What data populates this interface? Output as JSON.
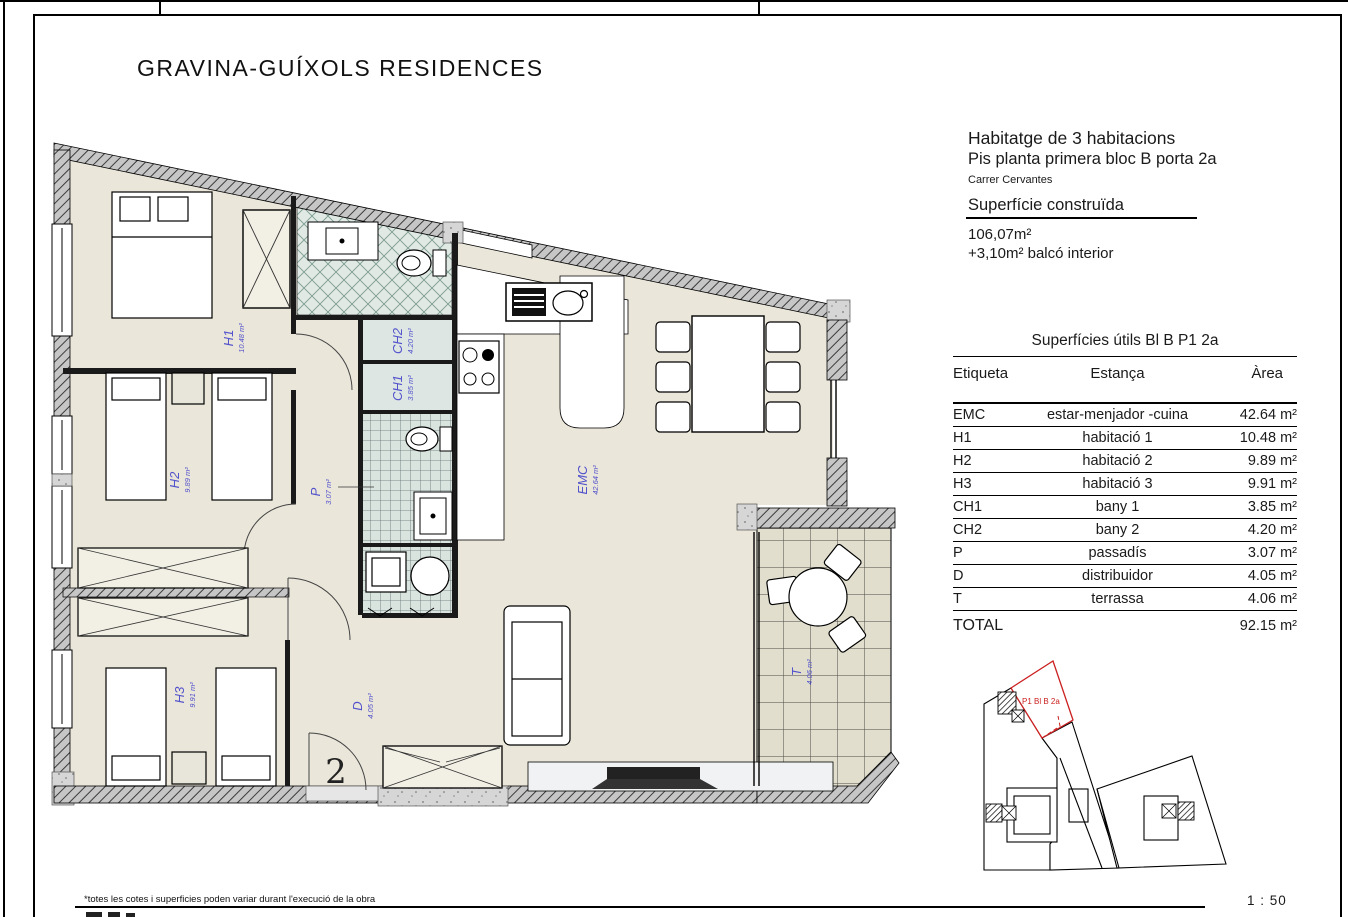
{
  "page": {
    "project_title": "GRAVINA-GUÍXOLS RESIDENCES",
    "scale": "1 : 50",
    "footnote": "*totes les cotes i superficies poden variar durant l'execució de la obra"
  },
  "info": {
    "heading": "Habitatge de 3 habitacions",
    "subheading": "Pis planta primera bloc B porta 2a",
    "address": "Carrer Cervantes",
    "built_section_title": "Superfície construïda",
    "built_area": "106,07m²",
    "balcony_area": "+3,10m² balcó interior"
  },
  "areas_table": {
    "title": "Superfícies útils Bl B P1 2a",
    "columns": [
      "Etiqueta",
      "Estança",
      "Àrea"
    ],
    "rows": [
      {
        "tag": "EMC",
        "room": "estar-menjador -cuina",
        "area": "42.64 m²"
      },
      {
        "tag": "H1",
        "room": "habitació 1",
        "area": "10.48 m²"
      },
      {
        "tag": "H2",
        "room": "habitació 2",
        "area": "9.89 m²"
      },
      {
        "tag": "H3",
        "room": "habitació 3",
        "area": "9.91 m²"
      },
      {
        "tag": "CH1",
        "room": "bany 1",
        "area": "3.85 m²"
      },
      {
        "tag": "CH2",
        "room": "bany 2",
        "area": "4.20 m²"
      },
      {
        "tag": "P",
        "room": "passadís",
        "area": "3.07 m²"
      },
      {
        "tag": "D",
        "room": "distribuidor",
        "area": "4.05 m²"
      },
      {
        "tag": "T",
        "room": "terrassa",
        "area": "4.06 m²"
      }
    ],
    "total_label": "TOTAL",
    "total_area": "92.15 m²"
  },
  "plan": {
    "labels": {
      "h1": {
        "name": "H1",
        "area": "10.48 m²"
      },
      "h2": {
        "name": "H2",
        "area": "9.89 m²"
      },
      "h3": {
        "name": "H3",
        "area": "9.91 m²"
      },
      "ch2": {
        "name": "CH2",
        "area": "4.20 m²"
      },
      "ch1": {
        "name": "CH1",
        "area": "3.85 m²"
      },
      "p": {
        "name": "P",
        "area": "3.07 m²"
      },
      "d": {
        "name": "D",
        "area": "4.05 m²"
      },
      "emc": {
        "name": "EMC",
        "area": "42.64 m²"
      },
      "t": {
        "name": "T",
        "area": "4.06 m²"
      }
    },
    "entry_number": "2"
  },
  "keyplan": {
    "unit_label": "P1 Bl B 2a"
  },
  "colors": {
    "accent_blue": "#5252cc",
    "highlight_red": "#cc2020"
  }
}
